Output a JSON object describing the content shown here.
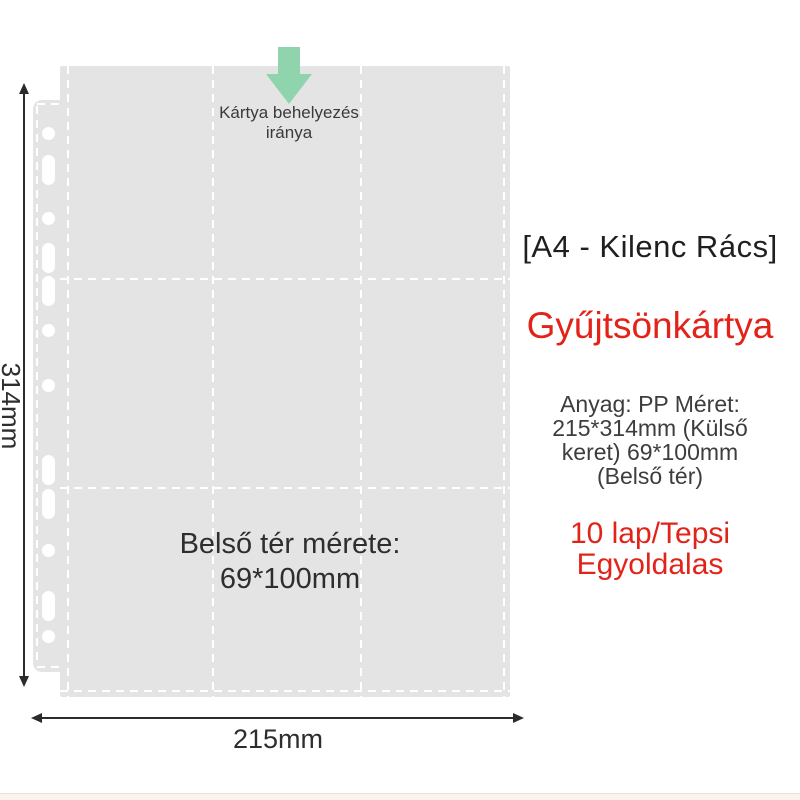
{
  "colors": {
    "page-gray": "#e4e4e4",
    "arrow-green": "#8fd4ad",
    "accent-red": "#e2231a",
    "text-dark": "#3a3a3a",
    "heading-dark": "#1f1f1f",
    "dimension-line": "#2b2b2b",
    "dash-white": "#ffffff",
    "bottom-band": "#faf3ec",
    "bottom-band-line": "#ece0d6"
  },
  "diagram": {
    "insertion_caption": {
      "line1": "Kártya behelyezés",
      "line2": "iránya"
    },
    "pocket_label": {
      "line1": "Belső tér mérete:",
      "line2": "69*100mm"
    },
    "height_dimension": "314mm",
    "width_dimension": "215mm",
    "grid": {
      "rows": 3,
      "cols": 3
    },
    "holes": [
      {
        "shape": "circle",
        "y": 133
      },
      {
        "shape": "oval",
        "y": 170
      },
      {
        "shape": "circle",
        "y": 218
      },
      {
        "shape": "oval",
        "y": 258
      },
      {
        "shape": "oval",
        "y": 291
      },
      {
        "shape": "circle",
        "y": 330
      },
      {
        "shape": "circle",
        "y": 385
      },
      {
        "shape": "oval",
        "y": 470
      },
      {
        "shape": "oval",
        "y": 504
      },
      {
        "shape": "circle",
        "y": 550
      },
      {
        "shape": "oval",
        "y": 606
      },
      {
        "shape": "circle",
        "y": 636
      }
    ]
  },
  "info_panel": {
    "heading": "[A4 - Kilenc Rács]",
    "product_name": "Gyűjtsönkártya",
    "specs": {
      "line1": "Anyag: PP Méret:",
      "line2": "215*314mm (Külső",
      "line3": "keret) 69*100mm",
      "line4": "(Belső tér)"
    },
    "highlight": {
      "line1": "10 lap/Tepsi",
      "line2": "Egyoldalas"
    }
  }
}
